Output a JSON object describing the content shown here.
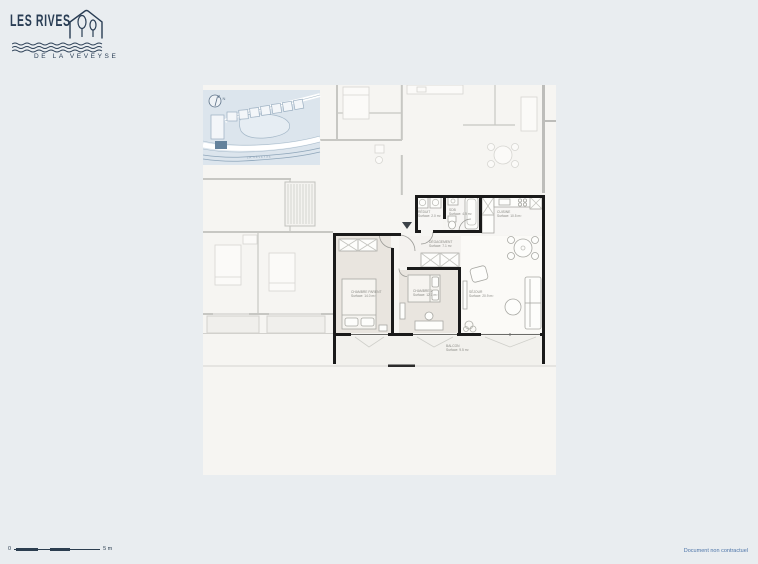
{
  "logo": {
    "title": "LES RIVES",
    "subtitle": "DE LA VEVEYSE"
  },
  "site_plan": {
    "north_label": "N",
    "river_label": "LA VEVEYSE"
  },
  "apartment": {
    "rooms": [
      {
        "name": "RÉDUIT",
        "area": "Surface: 2.0 m²"
      },
      {
        "name": "SDB",
        "area": "Surface: 4.9 m²"
      },
      {
        "name": "CUISINE",
        "area": "Surface: 10.5 m²"
      },
      {
        "name": "DÉGAGEMENT",
        "area": "Surface: 7.1 m²"
      },
      {
        "name": "CHAMBRE PARENT",
        "area": "Surface: 14.0 m²"
      },
      {
        "name": "CHAMBRE 1",
        "area": "Surface: 12.1 m²"
      },
      {
        "name": "SÉJOUR",
        "area": "Surface: 20.9 m²"
      },
      {
        "name": "BALCON",
        "area": "Surface: 9.5 m²"
      }
    ]
  },
  "scale_bar": {
    "start_label": "0",
    "end_label": "5 m"
  },
  "footer": {
    "disclaimer": "Document non contractuel"
  },
  "colors": {
    "page_background": "#e9edf0",
    "sheet_background": "#f6f5f2",
    "brand_navy": "#293d54",
    "subject_wall": "#1a1a1a",
    "neighbor_wall": "#c7c7c3",
    "bedroom_fill": "#e9e5df",
    "site_map_blue": "#dce5ed",
    "note_blue": "#4c74a8"
  }
}
